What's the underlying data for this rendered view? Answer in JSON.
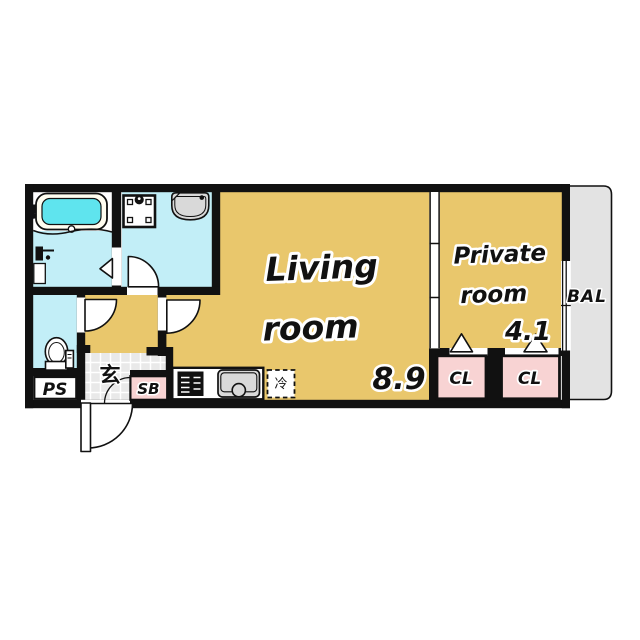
{
  "floorplan": {
    "living_room": {
      "line1": "Living",
      "line2": "room",
      "area": "8.9"
    },
    "private_room": {
      "line1": "Private",
      "line2": "room",
      "area": "4.1"
    },
    "balcony_label": "BAL",
    "closet1_label": "CL",
    "closet2_label": "CL",
    "pipe_space_label": "PS",
    "shoe_box_label": "SB",
    "entrance_label": "玄",
    "refrigerator_label": "冷",
    "colors": {
      "room_floor": "#e9c76c",
      "wet_area_floor": "#c2eef7",
      "bath_water": "#5fe4ee",
      "closet_fill": "#f8d3d3",
      "entrance_tile": "#e9e9e9",
      "balcony_fill": "#e3e3e3",
      "fixture_gray": "#d9d9d9",
      "wall": "#111111"
    }
  }
}
